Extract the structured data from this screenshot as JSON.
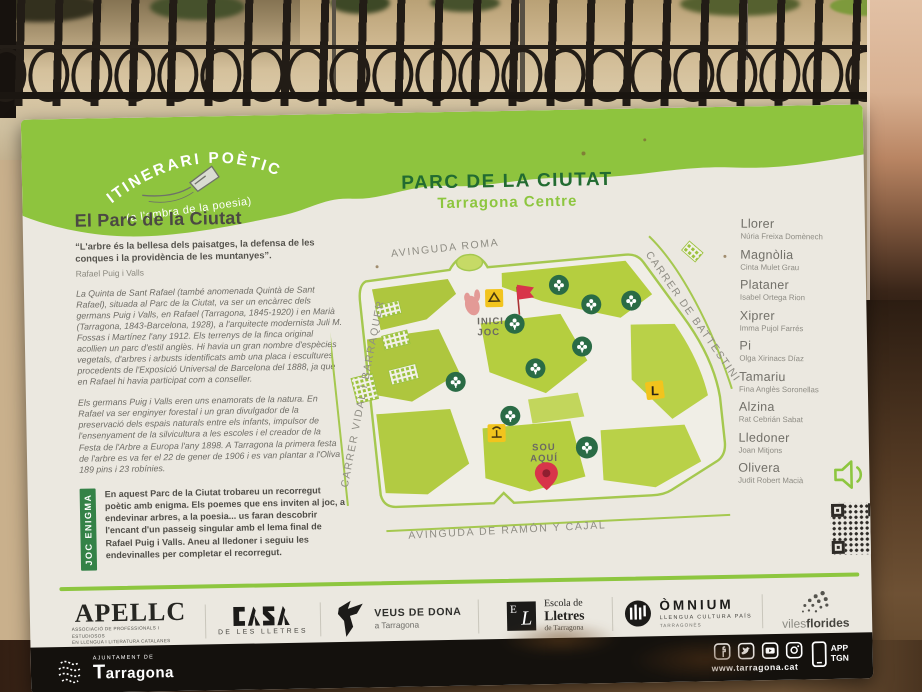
{
  "badge": {
    "title": "ITINERARI POÈTIC",
    "subtitle": "(a l'ombra de la poesia)"
  },
  "intro": {
    "heading": "El Parc de la Ciutat",
    "quote": "“L'arbre és la bellesa dels paisatges, la defensa de les conques i la providència de les muntanyes”.",
    "quote_author": "Rafael Puig i Valls",
    "para1": "La Quinta de Sant Rafael (també anomenada Quintà de Sant Rafael), situada al Parc de la Ciutat, va ser un encàrrec dels germans Puig i Valls, en Rafael (Tarragona, 1845-1920) i en Marià (Tarragona, 1843-Barcelona, 1928), a l'arquitecte modernista Juli M. Fossas i Martínez l'any 1912. Els terrenys de la finca original acollien un parc d'estil anglès. Hi havia un gran nombre d'espècies vegetals, d'arbres i arbusts identificats amb una placa i escultures procedents de l'Exposició Universal de Barcelona del 1888, ja que en Rafael hi havia participat com a conseller.",
    "para2": "Els germans Puig i Valls eren uns enamorats de la natura. En Rafael va ser enginyer forestal i un gran divulgador de la preservació dels espais naturals entre els infants, impulsor de l'ensenyament de la silvicultura a les escoles i el creador de la Festa de l'Arbre a Europa l'any 1898. A Tarragona la primera festa de l'arbre es va fer el 22 de gener de 1906 i es van plantar a l'Oliva 189 pins i 23 robínies."
  },
  "game": {
    "tab": "JOC ENIGMA",
    "text": "En aquest Parc de la Ciutat trobareu un recorregut poètic amb enigma. Els poemes que ens inviten al joc, a endevinar arbres, a la poesia... us faran descobrir l'encant d'un passeig singular amb el lema final de Rafael Puig i Valls. Aneu al lledoner i seguiu les endevinalles per completar el recorregut."
  },
  "map": {
    "title": "PARC DE LA CIUTAT",
    "subtitle": "Tarragona Centre",
    "streets": {
      "top": "AVINGUDA ROMA",
      "right": "CARRER DE BATTESTINI",
      "left": "CARRER VIDAL I BARRAQUER",
      "bottom": "AVINGUDA DE RAMÓN Y CAJAL"
    },
    "markers": {
      "start_line1": "INICI",
      "start_line2": "JOC",
      "here_line1": "SOU",
      "here_line2": "AQUÍ",
      "lledoner": "L"
    }
  },
  "trees": [
    {
      "name": "Llorer",
      "poet": "Núria Freixa Domènech"
    },
    {
      "name": "Magnòlia",
      "poet": "Cinta Mulet Grau"
    },
    {
      "name": "Plataner",
      "poet": "Isabel Ortega Rion"
    },
    {
      "name": "Xiprer",
      "poet": "Imma Pujol Farrés"
    },
    {
      "name": "Pi",
      "poet": "Olga Xirinacs Díaz"
    },
    {
      "name": "Tamariu",
      "poet": "Fina Anglès Soronellas"
    },
    {
      "name": "Alzina",
      "poet": "Rat Cebrián Sabat"
    },
    {
      "name": "Lledoner",
      "poet": "Joan Mitjons"
    },
    {
      "name": "Olivera",
      "poet": "Judit Robert Macià"
    }
  ],
  "partners": {
    "apellc": {
      "name": "APELLC",
      "sub1": "ASSOCIACIÓ DE PROFESSIONALS I ESTUDIOSOS",
      "sub2": "EN LLENGUA I LITERATURA CATALANES"
    },
    "casa": {
      "sub": "DE LES LLETRES"
    },
    "veus": {
      "name": "VEUS DE DONA",
      "sub": "a Tarragona"
    },
    "escola": {
      "mono1": "E",
      "mono2": "L",
      "l1": "Escola de",
      "l2": "Lletres",
      "l3": "de Tarragona"
    },
    "omnium": {
      "name": "ÒMNIUM",
      "sub": "LLENGUA CULTURA PAÍS",
      "sub2": "TARRAGONÈS"
    },
    "viles": {
      "part1": "viles",
      "part2": "florides"
    }
  },
  "footer": {
    "ajuntament": "AJUNTAMENT DE",
    "city": "Tarragona",
    "site": "www.tarragona.cat",
    "app_line1": "APP",
    "app_line2": "TGN"
  },
  "colors": {
    "accent_green": "#8dc63f",
    "band_green": "#8ec43e",
    "lawn_green": "#b5ce3f",
    "marker_green": "#2a6b45",
    "marker_yellow": "#f2c41d",
    "marker_red": "#d8344a"
  }
}
